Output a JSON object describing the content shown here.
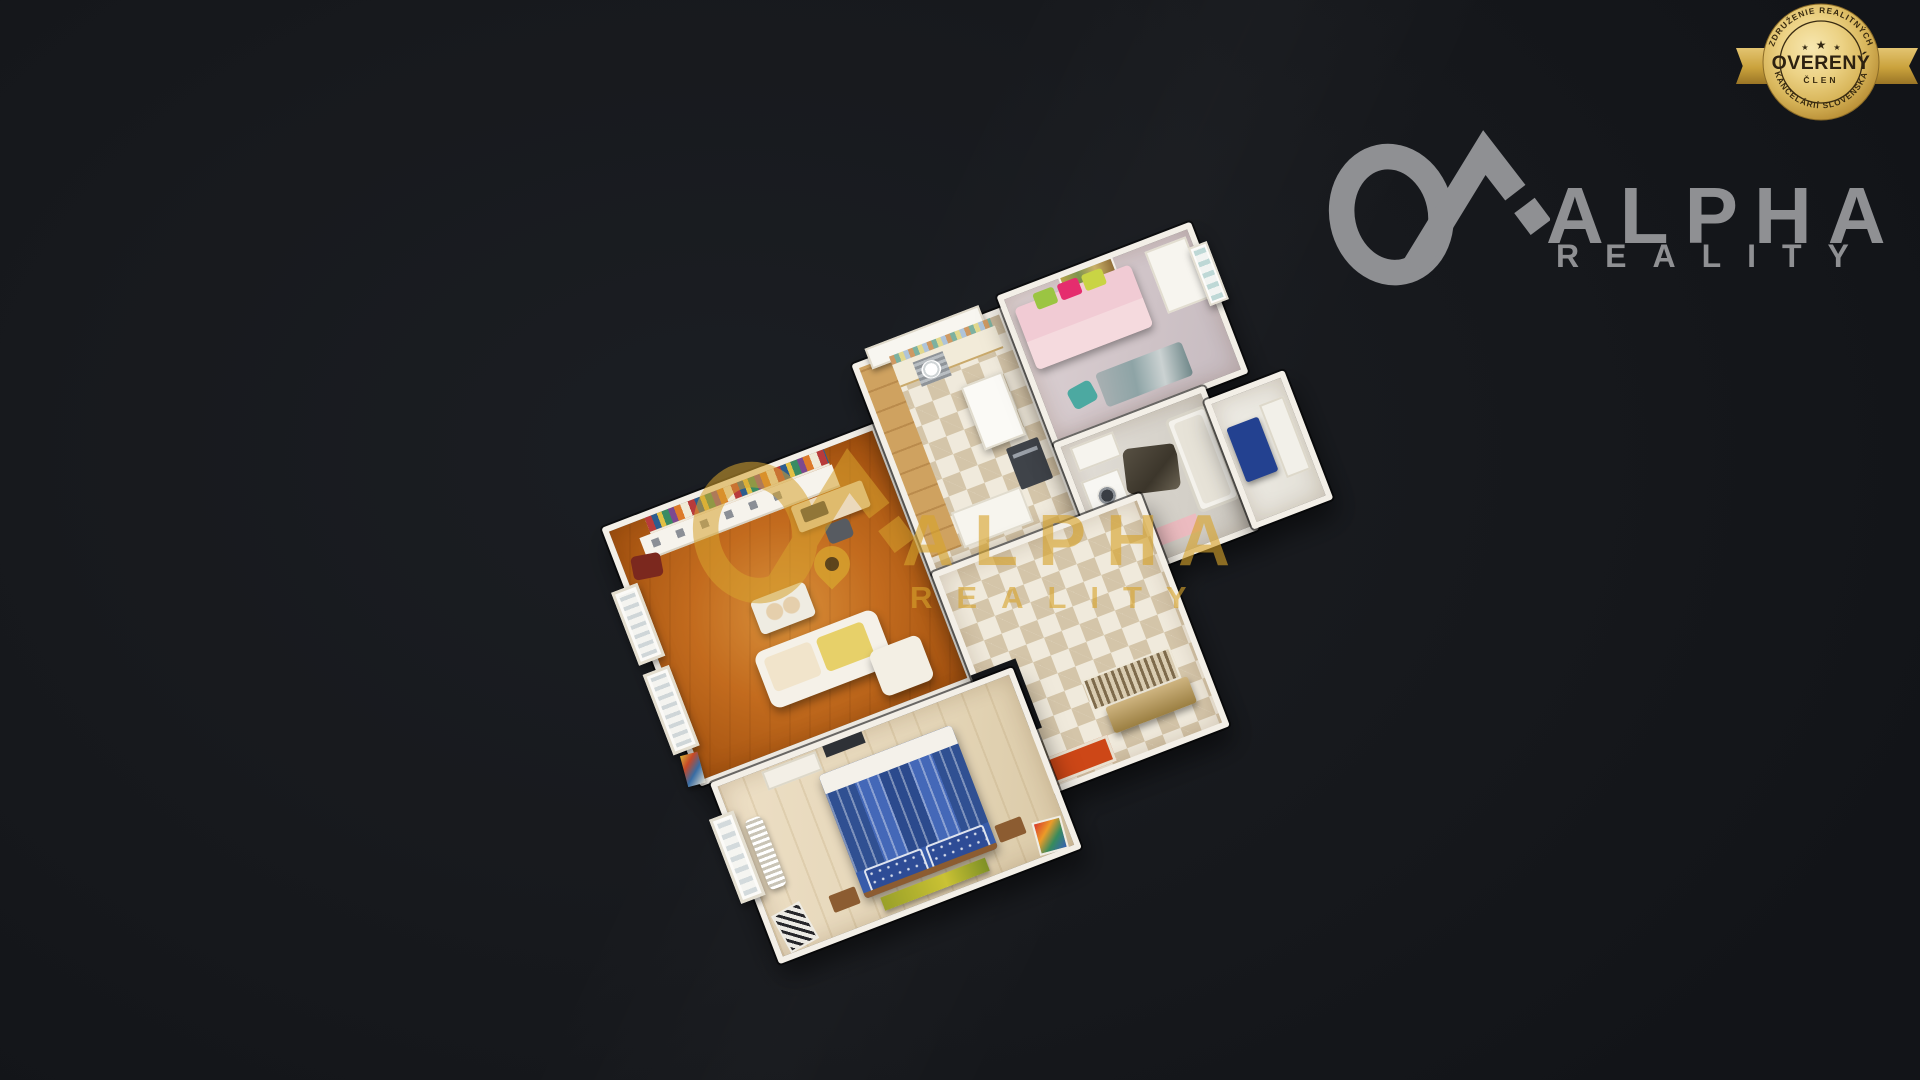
{
  "badge": {
    "top_arc": "ZDRUŽENIE REALITNÝCH",
    "bottom_arc": "KANCELÁRIÍ SLOVENSKA",
    "title": "OVERENÝ",
    "subtitle": "ČLEN",
    "star": "★",
    "gold_light": "#f6e5a8",
    "gold_dark": "#9a7426",
    "text_color": "#2e2312"
  },
  "logo": {
    "line1": "ALPHA",
    "line2": "REALITY",
    "color": "#8f9093"
  },
  "watermark": {
    "line1": "ALPHA",
    "line2": "REALITY",
    "color": "#d7a32e"
  },
  "scene": {
    "type": "3d-dollhouse-floorplan",
    "rooms": [
      {
        "name": "living-room",
        "floor_color": "#bf6c22"
      },
      {
        "name": "kitchen",
        "floor_color": "#f0eadd"
      },
      {
        "name": "kids-room",
        "floor_color": "#cfc3c7"
      },
      {
        "name": "bathroom",
        "floor_color": "#d6d2ca"
      },
      {
        "name": "hallway",
        "floor_color": "#f0eadd"
      },
      {
        "name": "small-bedroom",
        "floor_color": "#efede6"
      },
      {
        "name": "bedroom",
        "floor_color": "#e3d5b8"
      }
    ]
  }
}
